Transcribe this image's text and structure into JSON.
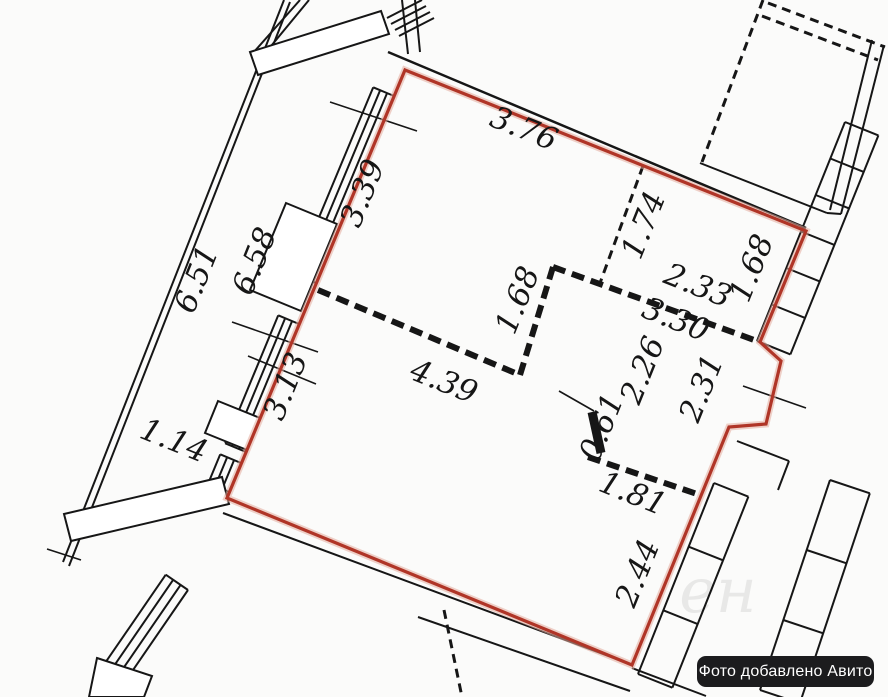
{
  "colors": {
    "ink": "#161616",
    "outline_red": "#b03527",
    "outline_red_glow": "#e3ab9d",
    "badge_bg": "#1c1c1e",
    "badge_text": "#ffffff"
  },
  "dimensions": [
    {
      "text": "3.76",
      "x": 520,
      "y": 138,
      "angle": 22
    },
    {
      "text": "3.39",
      "x": 372,
      "y": 197,
      "angle": -68
    },
    {
      "text": "6.58",
      "x": 264,
      "y": 265,
      "angle": -68
    },
    {
      "text": "6.51",
      "x": 206,
      "y": 283,
      "angle": -68
    },
    {
      "text": "3.13",
      "x": 295,
      "y": 390,
      "angle": -68
    },
    {
      "text": "1.14",
      "x": 170,
      "y": 450,
      "angle": 22
    },
    {
      "text": "1.74",
      "x": 653,
      "y": 229,
      "angle": -68
    },
    {
      "text": "2.33",
      "x": 694,
      "y": 295,
      "angle": 22
    },
    {
      "text": "1.68",
      "x": 761,
      "y": 272,
      "angle": -68
    },
    {
      "text": "3.30",
      "x": 672,
      "y": 329,
      "angle": 22
    },
    {
      "text": "1.68",
      "x": 527,
      "y": 304,
      "angle": -68
    },
    {
      "text": "4.39",
      "x": 440,
      "y": 391,
      "angle": 22
    },
    {
      "text": "2.26",
      "x": 652,
      "y": 374,
      "angle": -68
    },
    {
      "text": "2.31",
      "x": 711,
      "y": 392,
      "angle": -68
    },
    {
      "text": "0.61",
      "x": 611,
      "y": 431,
      "angle": -68
    },
    {
      "text": "1.81",
      "x": 629,
      "y": 503,
      "angle": 22
    },
    {
      "text": "2.44",
      "x": 647,
      "y": 577,
      "angle": -68
    }
  ],
  "watermark": {
    "text": "ен"
  },
  "badge": {
    "text": "Фото добавлено Авито"
  }
}
